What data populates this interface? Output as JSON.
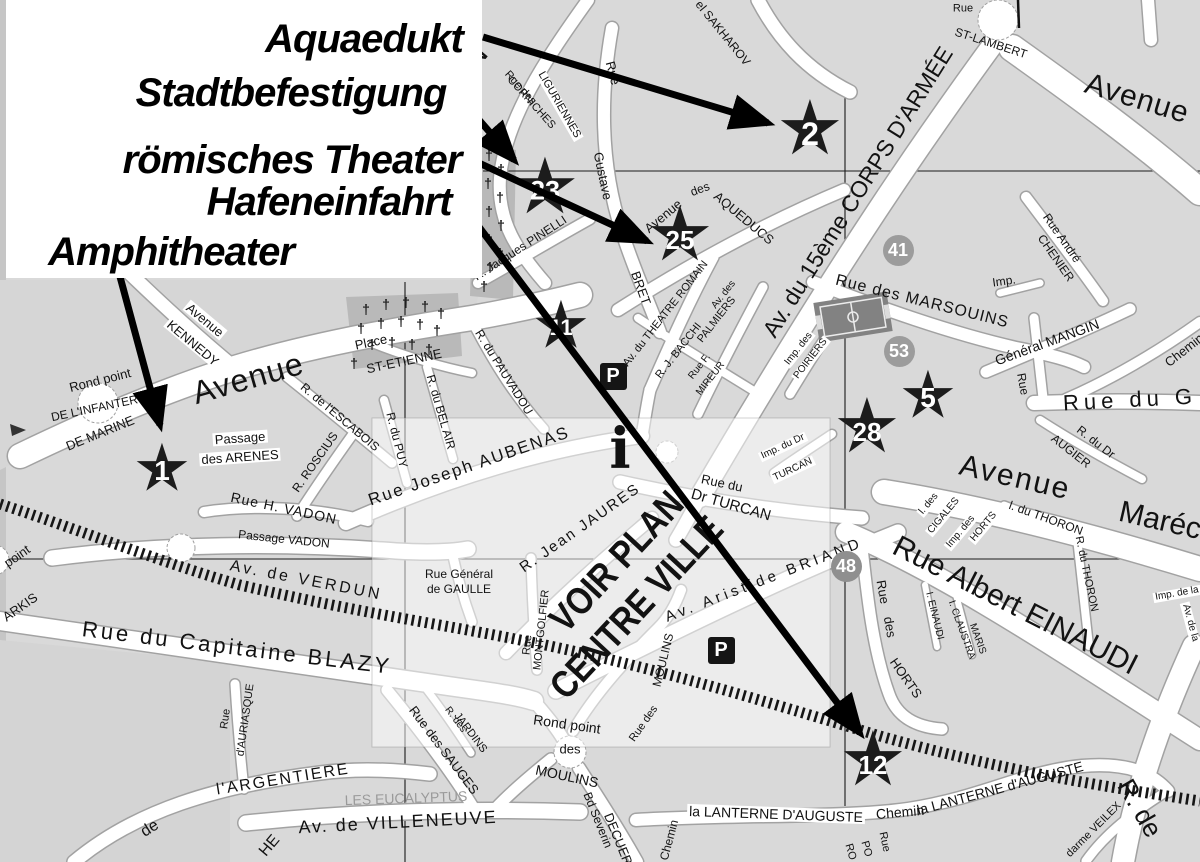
{
  "map_title": "Stadtplan mit römischen Monumenten",
  "legend": {
    "items": [
      {
        "label": "Aquaedukt",
        "x": 358,
        "y": 39,
        "size": 40,
        "target_star": "2",
        "arrow": {
          "x1": 483,
          "y1": 37,
          "x2": 768,
          "y2": 123
        }
      },
      {
        "label": "Stadtbefestigung",
        "x": 285,
        "y": 93,
        "size": 40,
        "target_star": "23",
        "arrow": {
          "x1": 459,
          "y1": 97,
          "x2": 514,
          "y2": 160
        }
      },
      {
        "label": "römisches Theater",
        "x": 286,
        "y": 160,
        "size": 40,
        "target_star": "25",
        "arrow": {
          "x1": 479,
          "y1": 163,
          "x2": 647,
          "y2": 241
        }
      },
      {
        "label": "Hafeneinfahrt",
        "x": 323,
        "y": 202,
        "size": 40,
        "target_star": "12",
        "arrow": {
          "x1": 464,
          "y1": 207,
          "x2": 860,
          "y2": 733
        }
      },
      {
        "label": "Amphitheater",
        "x": 165,
        "y": 252,
        "size": 40,
        "target_star": "1",
        "arrow": {
          "x1": 119,
          "y1": 273,
          "x2": 160,
          "y2": 425
        }
      }
    ]
  },
  "stars": [
    {
      "n": "1",
      "x": 162,
      "y": 470,
      "s": 66
    },
    {
      "n": "2",
      "x": 810,
      "y": 132,
      "s": 76
    },
    {
      "n": "23",
      "x": 545,
      "y": 189,
      "s": 78
    },
    {
      "n": "25",
      "x": 680,
      "y": 238,
      "s": 76
    },
    {
      "n": "11",
      "x": 561,
      "y": 327,
      "s": 66
    },
    {
      "n": "5",
      "x": 928,
      "y": 397,
      "s": 66
    },
    {
      "n": "28",
      "x": 867,
      "y": 430,
      "s": 76
    },
    {
      "n": "12",
      "x": 873,
      "y": 763,
      "s": 76
    }
  ],
  "badges": [
    {
      "n": "41",
      "x": 898,
      "y": 250
    },
    {
      "n": "53",
      "x": 899,
      "y": 351
    },
    {
      "n": "48",
      "x": 846,
      "y": 566
    }
  ],
  "icons": {
    "star_glyph": "★",
    "cross_glyph": "†",
    "parking_label": "P",
    "parking": [
      {
        "x": 613,
        "y": 376
      },
      {
        "x": 721,
        "y": 650
      }
    ],
    "info": {
      "x": 620,
      "y": 450,
      "label": "i"
    }
  },
  "crosses": [
    [
      489,
      155
    ],
    [
      501,
      169
    ],
    [
      488,
      183
    ],
    [
      500,
      197
    ],
    [
      489,
      211
    ],
    [
      501,
      225
    ],
    [
      489,
      239
    ],
    [
      500,
      253
    ],
    [
      490,
      267
    ],
    [
      484,
      286
    ],
    [
      366,
      309
    ],
    [
      386,
      304
    ],
    [
      406,
      302
    ],
    [
      425,
      306
    ],
    [
      441,
      313
    ],
    [
      361,
      328
    ],
    [
      381,
      323
    ],
    [
      401,
      321
    ],
    [
      420,
      324
    ],
    [
      437,
      330
    ],
    [
      372,
      344
    ],
    [
      392,
      342
    ],
    [
      412,
      344
    ],
    [
      429,
      349
    ],
    [
      354,
      363
    ]
  ],
  "labels": [
    {
      "t": "ON",
      "x": 468,
      "y": 66,
      "r": -50,
      "s": 30
    },
    {
      "t": "Rue des",
      "x": 520,
      "y": 88,
      "r": 48,
      "s": 11
    },
    {
      "t": "CORNICHES",
      "x": 531,
      "y": 103,
      "r": 48,
      "s": 11
    },
    {
      "t": "LIGURIENNES",
      "x": 559,
      "y": 105,
      "r": 60,
      "s": 11,
      "bg": 1
    },
    {
      "t": "Rue",
      "x": 613,
      "y": 73,
      "r": 75,
      "s": 13
    },
    {
      "t": "Gustave",
      "x": 603,
      "y": 176,
      "r": 78,
      "s": 13
    },
    {
      "t": "BRET",
      "x": 641,
      "y": 288,
      "r": 70,
      "s": 13
    },
    {
      "t": "el SAKHAROV",
      "x": 723,
      "y": 33,
      "r": 51,
      "s": 12
    },
    {
      "t": "ST-LAMBERT",
      "x": 991,
      "y": 43,
      "r": 18,
      "s": 12
    },
    {
      "t": "Rue",
      "x": 963,
      "y": 9,
      "r": 0,
      "s": 11
    },
    {
      "t": "Avenue",
      "x": 1137,
      "y": 99,
      "r": 17,
      "s": 30,
      "sp": 1
    },
    {
      "t": "Av. du 15ème CORPS D'ARMÉE",
      "x": 858,
      "y": 192,
      "r": -58,
      "s": 23
    },
    {
      "t": "Avenue",
      "x": 663,
      "y": 216,
      "r": -40,
      "s": 13
    },
    {
      "t": "des",
      "x": 700,
      "y": 189,
      "r": -20,
      "s": 12
    },
    {
      "t": "AQUEDUCS",
      "x": 744,
      "y": 218,
      "r": 40,
      "s": 13
    },
    {
      "t": "R. Jacques PINELLI",
      "x": 520,
      "y": 248,
      "r": -33,
      "s": 12
    },
    {
      "t": "Av. du THEATRE ROMAIN",
      "x": 666,
      "y": 314,
      "r": -52,
      "s": 11
    },
    {
      "t": "Av. des",
      "x": 724,
      "y": 295,
      "r": -52,
      "s": 10
    },
    {
      "t": "PALMIERS",
      "x": 717,
      "y": 320,
      "r": -52,
      "s": 11
    },
    {
      "t": "R. J. BACCHI",
      "x": 679,
      "y": 351,
      "r": -52,
      "s": 11
    },
    {
      "t": "Rue F.",
      "x": 700,
      "y": 367,
      "r": -52,
      "s": 10
    },
    {
      "t": "MIREUR",
      "x": 711,
      "y": 379,
      "r": -52,
      "s": 10
    },
    {
      "t": "Imp. des",
      "x": 799,
      "y": 349,
      "r": -52,
      "s": 10,
      "bg": 1
    },
    {
      "t": "POIRIERS",
      "x": 811,
      "y": 359,
      "r": -52,
      "s": 10,
      "bg": 1
    },
    {
      "t": "Imp.",
      "x": 1004,
      "y": 281,
      "r": -8,
      "s": 12
    },
    {
      "t": "Rue André",
      "x": 1062,
      "y": 238,
      "r": 55,
      "s": 12
    },
    {
      "t": "CHENIER",
      "x": 1056,
      "y": 258,
      "r": 55,
      "s": 12
    },
    {
      "t": "Rue des MARSOUINS",
      "x": 922,
      "y": 302,
      "r": 14,
      "s": 16,
      "sp": 1
    },
    {
      "t": "Général MANGIN",
      "x": 1047,
      "y": 342,
      "r": -20,
      "s": 14
    },
    {
      "t": "Rue",
      "x": 1023,
      "y": 384,
      "r": 80,
      "s": 12
    },
    {
      "t": "Chemin",
      "x": 1184,
      "y": 350,
      "r": -38,
      "s": 13
    },
    {
      "t": "Rue du G",
      "x": 1130,
      "y": 400,
      "r": -3,
      "s": 22,
      "sp": 5
    },
    {
      "t": "R. du Dr",
      "x": 1096,
      "y": 442,
      "r": 38,
      "s": 12
    },
    {
      "t": "AUGIER",
      "x": 1071,
      "y": 451,
      "r": 38,
      "s": 12
    },
    {
      "t": "Avenue",
      "x": 1015,
      "y": 478,
      "r": 13,
      "s": 30,
      "sp": 2
    },
    {
      "t": "Maréc",
      "x": 1160,
      "y": 521,
      "r": 13,
      "s": 30
    },
    {
      "t": "l. des",
      "x": 929,
      "y": 504,
      "r": -50,
      "s": 10,
      "bg": 1
    },
    {
      "t": "CIGALES",
      "x": 944,
      "y": 516,
      "r": -50,
      "s": 10,
      "bg": 1
    },
    {
      "t": "Imp. des",
      "x": 961,
      "y": 532,
      "r": -50,
      "s": 10,
      "bg": 1
    },
    {
      "t": "HORTS",
      "x": 984,
      "y": 527,
      "r": -50,
      "s": 10,
      "bg": 1
    },
    {
      "t": "l. du THORON",
      "x": 1046,
      "y": 518,
      "r": 20,
      "s": 12
    },
    {
      "t": "R. du THORON",
      "x": 1086,
      "y": 574,
      "r": 78,
      "s": 11
    },
    {
      "t": "Imp. de la",
      "x": 1177,
      "y": 594,
      "r": -10,
      "s": 10,
      "bg": 1
    },
    {
      "t": "Av. de la",
      "x": 1190,
      "y": 623,
      "r": 75,
      "s": 10,
      "bg": 1
    },
    {
      "t": "Rue Albert EINAUDI",
      "x": 1015,
      "y": 606,
      "r": 27,
      "s": 30
    },
    {
      "t": "I. EINAUDI",
      "x": 934,
      "y": 616,
      "r": 76,
      "s": 10
    },
    {
      "t": "I. CLAUSTRA",
      "x": 961,
      "y": 630,
      "r": 70,
      "s": 10
    },
    {
      "t": "MARIS",
      "x": 977,
      "y": 639,
      "r": 70,
      "s": 10
    },
    {
      "t": "Rue",
      "x": 883,
      "y": 592,
      "r": 80,
      "s": 13
    },
    {
      "t": "des",
      "x": 890,
      "y": 627,
      "r": 80,
      "s": 13
    },
    {
      "t": "HORTS",
      "x": 906,
      "y": 678,
      "r": 55,
      "s": 13
    },
    {
      "t": "Rue du",
      "x": 722,
      "y": 483,
      "r": 12,
      "s": 13
    },
    {
      "t": "Dr TURCAN",
      "x": 731,
      "y": 505,
      "r": 16,
      "s": 15
    },
    {
      "t": "Imp. du Dr",
      "x": 783,
      "y": 447,
      "r": -25,
      "s": 10,
      "bg": 1
    },
    {
      "t": "TURCAN",
      "x": 793,
      "y": 470,
      "r": -25,
      "s": 10,
      "bg": 1
    },
    {
      "t": "Av. Aristide BRIAND",
      "x": 764,
      "y": 580,
      "r": -21,
      "s": 15,
      "sp": 4
    },
    {
      "t": "R. Jean JAURES",
      "x": 580,
      "y": 528,
      "r": -35,
      "s": 15,
      "sp": 2
    },
    {
      "t": "VOIR PLAN",
      "x": 617,
      "y": 562,
      "r": -47,
      "s": 38,
      "w": 700,
      "sx": 0.85
    },
    {
      "t": "CENTRE VILLE",
      "x": 637,
      "y": 608,
      "r": -47,
      "s": 38,
      "w": 700,
      "sx": 0.85
    },
    {
      "t": "Rue",
      "x": 528,
      "y": 645,
      "r": -84,
      "s": 11
    },
    {
      "t": "MONTGOLFIER",
      "x": 542,
      "y": 630,
      "r": -84,
      "s": 11
    },
    {
      "t": "MOULINS",
      "x": 663,
      "y": 660,
      "r": -76,
      "s": 12
    },
    {
      "t": "Rue des",
      "x": 644,
      "y": 724,
      "r": -55,
      "s": 11
    },
    {
      "t": "Rond point",
      "x": 567,
      "y": 724,
      "r": 8,
      "s": 14
    },
    {
      "t": "des",
      "x": 570,
      "y": 749,
      "r": 0,
      "s": 13
    },
    {
      "t": "MOULINS",
      "x": 567,
      "y": 776,
      "r": 12,
      "s": 14
    },
    {
      "t": "Bd Severin",
      "x": 598,
      "y": 820,
      "r": 68,
      "s": 12
    },
    {
      "t": "DECUERS",
      "x": 620,
      "y": 843,
      "r": 68,
      "s": 13
    },
    {
      "t": "Chemin",
      "x": 669,
      "y": 840,
      "r": -75,
      "s": 12
    },
    {
      "t": "la LANTERNE D'AUGUSTE",
      "x": 776,
      "y": 814,
      "r": 2,
      "s": 14,
      "bg": 1
    },
    {
      "t": "Chemin",
      "x": 900,
      "y": 812,
      "r": -5,
      "s": 14
    },
    {
      "t": "la LANTERNE d'AUGUSTE",
      "x": 1000,
      "y": 788,
      "r": -15,
      "s": 14
    },
    {
      "t": "darme VEILEX",
      "x": 1094,
      "y": 830,
      "r": -45,
      "s": 11
    },
    {
      "t": "R. de",
      "x": 1140,
      "y": 808,
      "r": 60,
      "s": 26
    },
    {
      "t": "Rue",
      "x": 884,
      "y": 842,
      "r": 78,
      "s": 11
    },
    {
      "t": "PO",
      "x": 866,
      "y": 849,
      "r": 74,
      "s": 11
    },
    {
      "t": "RO",
      "x": 850,
      "y": 852,
      "r": 74,
      "s": 11
    },
    {
      "t": "Rond point",
      "x": 100,
      "y": 380,
      "r": -14,
      "s": 13
    },
    {
      "t": "DE L'INFANTERIE",
      "x": 100,
      "y": 407,
      "r": -12,
      "s": 12
    },
    {
      "t": "DE MARINE",
      "x": 100,
      "y": 433,
      "r": -22,
      "s": 13
    },
    {
      "t": "Avenue",
      "x": 205,
      "y": 320,
      "r": 40,
      "s": 13,
      "bg": 1
    },
    {
      "t": "KENNEDY",
      "x": 193,
      "y": 343,
      "r": 40,
      "s": 13,
      "bg": 1
    },
    {
      "t": "Avenue",
      "x": 248,
      "y": 378,
      "r": -16,
      "s": 32,
      "sp": 1
    },
    {
      "t": "Passage",
      "x": 240,
      "y": 438,
      "r": -4,
      "s": 13,
      "bg": 1
    },
    {
      "t": "des ARENES",
      "x": 240,
      "y": 457,
      "r": -4,
      "s": 13,
      "bg": 1
    },
    {
      "t": "R. de l'ESCABOIS",
      "x": 340,
      "y": 417,
      "r": 40,
      "s": 12
    },
    {
      "t": "R. ROSCIUS",
      "x": 315,
      "y": 462,
      "r": -55,
      "s": 12
    },
    {
      "t": "R. du PUY",
      "x": 397,
      "y": 440,
      "r": 76,
      "s": 12
    },
    {
      "t": "R. du BEL AIR",
      "x": 441,
      "y": 412,
      "r": 74,
      "s": 12
    },
    {
      "t": "R. du PAUVADOU",
      "x": 504,
      "y": 372,
      "r": 58,
      "s": 12
    },
    {
      "t": "Place",
      "x": 371,
      "y": 342,
      "r": -12,
      "s": 13
    },
    {
      "t": "ST-ETIENNE",
      "x": 404,
      "y": 361,
      "r": -12,
      "s": 13
    },
    {
      "t": "Rue Joseph AUBENAS",
      "x": 469,
      "y": 466,
      "r": -19,
      "s": 17,
      "sp": 2
    },
    {
      "t": "Rue H. VADON",
      "x": 284,
      "y": 508,
      "r": 12,
      "s": 14,
      "sp": 1
    },
    {
      "t": "Passage VADON",
      "x": 284,
      "y": 539,
      "r": 6,
      "s": 12
    },
    {
      "t": "Av. de VERDUN",
      "x": 306,
      "y": 581,
      "r": 11,
      "s": 16,
      "sp": 3
    },
    {
      "t": "Rue Général",
      "x": 459,
      "y": 574,
      "r": 0,
      "s": 12
    },
    {
      "t": "de GAULLE",
      "x": 459,
      "y": 589,
      "r": 0,
      "s": 12
    },
    {
      "t": "Rue du Capitaine BLAZY",
      "x": 237,
      "y": 648,
      "r": 7,
      "s": 22,
      "sp": 3
    },
    {
      "t": "point",
      "x": 17,
      "y": 556,
      "r": -35,
      "s": 13
    },
    {
      "t": "ARKIS",
      "x": 20,
      "y": 607,
      "r": -35,
      "s": 13
    },
    {
      "t": "Rue",
      "x": 226,
      "y": 719,
      "r": -82,
      "s": 11
    },
    {
      "t": "d'AURIASQUE",
      "x": 246,
      "y": 720,
      "r": -82,
      "s": 11
    },
    {
      "t": "de",
      "x": 150,
      "y": 829,
      "r": -32,
      "s": 16
    },
    {
      "t": "l'ARGENTIERE",
      "x": 283,
      "y": 780,
      "r": -9,
      "s": 16,
      "sp": 2
    },
    {
      "t": "Av. de VILLENEUVE",
      "x": 398,
      "y": 822,
      "r": -3,
      "s": 18,
      "sp": 2
    },
    {
      "t": "LES EUCALYPTUS",
      "x": 406,
      "y": 798,
      "r": -2,
      "s": 14,
      "c": "#9a9a9a"
    },
    {
      "t": "Rue des SAUGES",
      "x": 444,
      "y": 750,
      "r": 53,
      "s": 13
    },
    {
      "t": "R. des",
      "x": 455,
      "y": 720,
      "r": 53,
      "s": 10
    },
    {
      "t": "JARDINS",
      "x": 470,
      "y": 733,
      "r": 53,
      "s": 11
    },
    {
      "t": "HE",
      "x": 270,
      "y": 846,
      "r": -50,
      "s": 16
    }
  ],
  "colors": {
    "paper": "#d9d9d9",
    "street": "#ffffff",
    "street_casing": "#a2a2a2",
    "ink": "#121212",
    "badge_gray": "#9c9c9c",
    "star_black": "#1c1c1c",
    "overlay_white": "rgba(255,255,255,0.5)"
  }
}
